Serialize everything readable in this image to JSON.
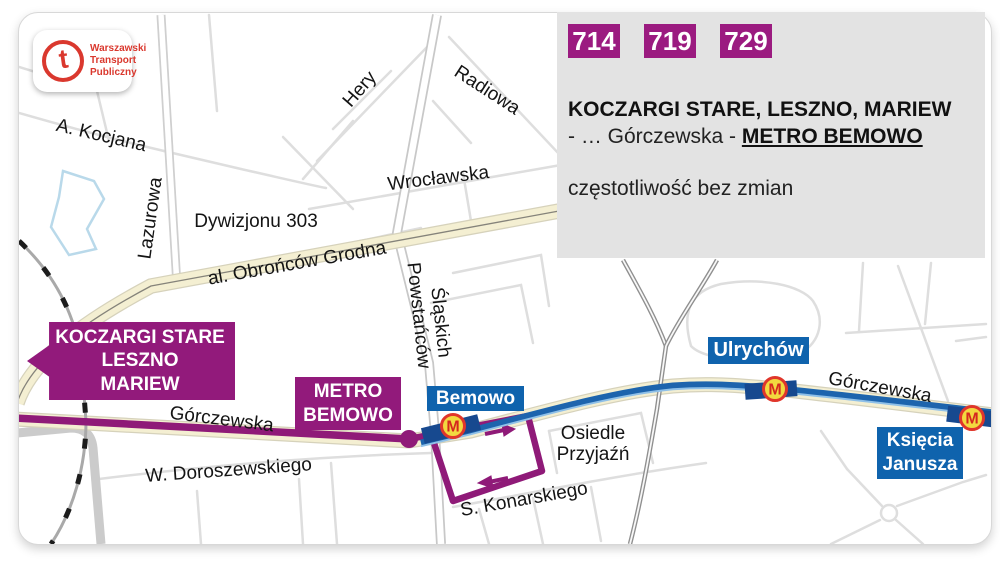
{
  "logo": {
    "letter": "t",
    "lines": [
      "Warszawski",
      "Transport",
      "Publiczny"
    ]
  },
  "panel": {
    "routes": [
      "714",
      "719",
      "729"
    ],
    "headline": "KOCZARGI STARE, LESZNO, MARIEW",
    "route_prefix": "- … Górczewska - ",
    "route_terminus": "METRO BEMOWO",
    "note": "częstotliwość bez zmian"
  },
  "map": {
    "terminus_label": [
      "KOCZARGI STARE",
      "LESZNO",
      "MARIEW"
    ],
    "metro_label": [
      "METRO",
      "BEMOWO"
    ],
    "stations": {
      "bemowo": "Bemowo",
      "ulrychow": "Ulrychów",
      "ksiecia_1": "Księcia",
      "ksiecia_2": "Janusza"
    },
    "metro_letter": "M",
    "streets": {
      "kocjana": "A. Kocjana",
      "lazurowa": "Lazurowa",
      "dywizjonu": "Dywizjonu 303",
      "obroncow": "al. Obrońców Grodna",
      "hery": "Hery",
      "radiowa": "Radiowa",
      "wroclawska": "Wrocławska",
      "powstancow_1": "Powstańców",
      "powstancow_2": "Śląskich",
      "gorczewska_left": "Górczewska",
      "gorczewska_right": "Górczewska",
      "doroszewskiego": "W. Doroszewskiego",
      "osiedle_1": "Osiedle",
      "osiedle_2": "Przyjaźń",
      "konarskiego": "S. Konarskiego"
    },
    "colors": {
      "route_magenta": "#8f1a78",
      "metro_blue": "#1d64ad",
      "station_box_blue": "#0f63ad",
      "road_yellow": "#f4efd2",
      "panel_gray": "#e3e3e3",
      "brand_red": "#da382e",
      "metro_logo_yellow": "#f2d93f"
    }
  }
}
